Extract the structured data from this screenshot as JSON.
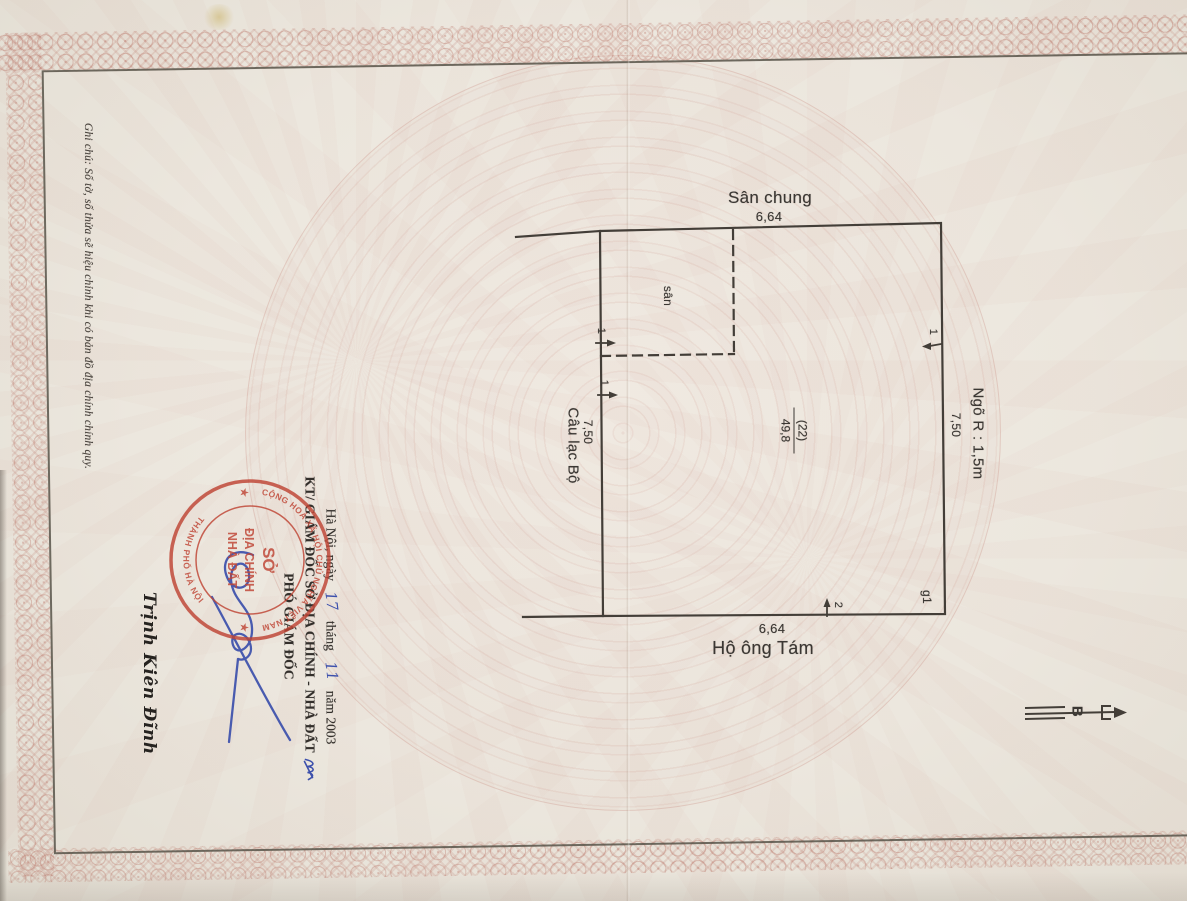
{
  "note_margin": "Ghi chú: Số tờ, số thửa sẽ hiệu chỉnh khi có bản đồ địa chính chính quy.",
  "diagram": {
    "adjacent_top": "Sân chung",
    "dim_top": "6,64",
    "adjacent_bottom": "Hộ ông Tám",
    "dim_bottom": "6,64",
    "adjacent_right": "Ngõ R : 1,5m",
    "dim_right": "7,50",
    "adjacent_left": "Câu lạc Bộ",
    "dim_left": "7,50",
    "parcel_number": "(22)",
    "parcel_area": "49,8",
    "yard_label": "sân",
    "gate_label": "g1",
    "point_marker_1": "1",
    "point_marker_2": "2",
    "north_label": "B"
  },
  "signing": {
    "date": {
      "prefix": "Hà Nội, ngày",
      "day": "17",
      "thang": "tháng",
      "month": "11",
      "nam": "năm  2003"
    },
    "authority": "KT/ GIÁM ĐỐC SỞ ĐỊA CHÍNH - NHÀ ĐẤT",
    "title": "PHÓ GIÁM ĐỐC",
    "signer": "Trịnh Kiên Đĩnh"
  },
  "stamp": {
    "ring_top": "CỘNG HOÀ XÃ HỘI CHỦ NGHĨA VIỆT NAM",
    "ring_bottom": "THÀNH PHỐ HÀ NỘI",
    "center_1": "SỞ",
    "center_2": "ĐỊA CHÍNH",
    "center_3": "NHÀ ĐẤT",
    "star": "★"
  },
  "colors": {
    "stamp_red": "#bf4434",
    "ink_blue": "#3c50ac",
    "line_dark": "#433e38",
    "pattern_pink": "#c98d80"
  }
}
